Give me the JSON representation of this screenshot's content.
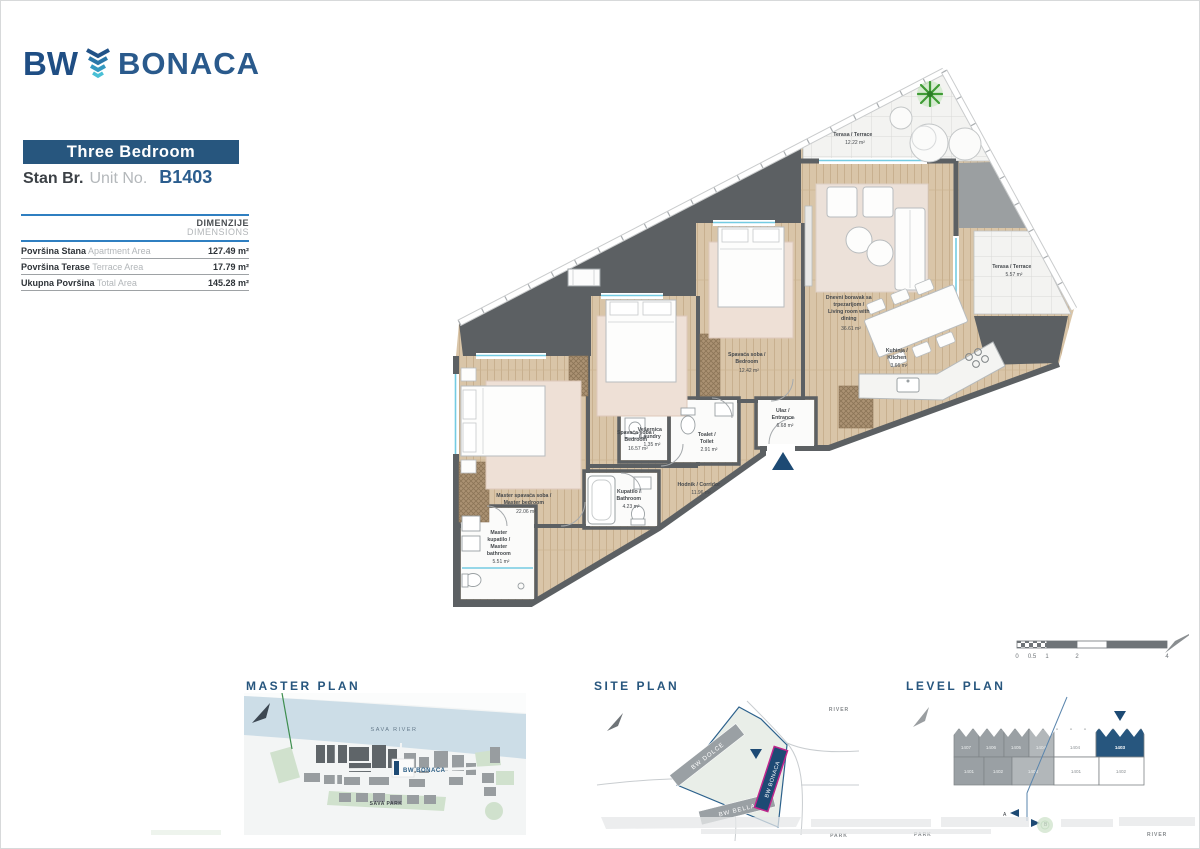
{
  "header": {
    "logo_bw": "BW",
    "logo_name": "BONACA",
    "unit_type": "Three Bedroom",
    "unit_label_sr": "Stan Br.",
    "unit_label_en": "Unit No.",
    "unit_number": "B1403"
  },
  "dimensions_table": {
    "header_sr": "DIMENZIJE",
    "header_en": "DIMENSIONS",
    "rows": [
      {
        "sr": "Površina Stana",
        "en": "Apartment Area",
        "value": "127.49 m²"
      },
      {
        "sr": "Površina Terase",
        "en": "Terrace Area",
        "value": "17.79 m²"
      },
      {
        "sr": "Ukupna Površina",
        "en": "Total Area",
        "value": "145.28 m²"
      }
    ]
  },
  "floorplan": {
    "living": {
      "l1": "Dnevni boravak sa",
      "l2": "trpezarijom /",
      "l3": "Living room with",
      "l4": "dining",
      "area": "36.61 m²"
    },
    "kitchen": {
      "sr": "Kuhinja /",
      "en": "Kitchen",
      "area": "3.66 m²"
    },
    "bedroom1": {
      "sr": "Spavaća soba /",
      "en": "Bedroom",
      "area": "12.42 m²"
    },
    "bedroom2": {
      "sr": "Spavaća soba /",
      "en": "Bedroom",
      "area": "16.57 m²"
    },
    "master_bedroom": {
      "sr": "Master spavaća soba /",
      "en": "Master bedroom",
      "area": "22.06 m²"
    },
    "corridor": {
      "label": "Hodnik / Corridor",
      "area": "11.96 m²"
    },
    "bathroom": {
      "sr": "Kupatilo /",
      "en": "Bathroom",
      "area": "4.23 m²"
    },
    "master_bathroom": {
      "l1": "Master",
      "l2": "kupatilo /",
      "l3": "Master",
      "l4": "bathroom",
      "area": "5.51 m²"
    },
    "laundry": {
      "l1": "Vešernica",
      "l2": "/Laundry",
      "area": "1.35 m²"
    },
    "toilet": {
      "sr": "Toalet /",
      "en": "Toilet",
      "area": "2.91 m²"
    },
    "entrance": {
      "sr": "Ulaz /",
      "en": "Entrance",
      "area": "6.68 m²"
    },
    "terrace_main": {
      "label": "Terasa / Terrace",
      "area": "12.22 m²"
    },
    "terrace_small": {
      "label": "Terasa / Terrace",
      "area": "5.57 m²"
    }
  },
  "scale_bar": {
    "ticks": [
      "0",
      "0.5",
      "1",
      "2",
      "4"
    ]
  },
  "thumbnails": {
    "master_plan": {
      "title": "MASTER PLAN",
      "river_label": "SAVA RIVER",
      "project_label": "BW BONACA",
      "park_label": "SAVA PARK"
    },
    "site_plan": {
      "title": "SITE PLAN",
      "building_dolce": "BW DOLCE",
      "building_bonaca": "BW BONACA",
      "building_bella": "BW BELLA",
      "river_label": "RIVER",
      "park_label": "PARK"
    },
    "level_plan": {
      "title": "LEVEL PLAN",
      "gray_top": [
        "1407",
        "1406",
        "1405",
        "1404"
      ],
      "gray_bottom": [
        "1401",
        "1402",
        "1403"
      ],
      "white_top": [
        "1404",
        "1403"
      ],
      "white_bottom": [
        "1401",
        "1402"
      ],
      "highlighted_unit": "1403",
      "section_a": "A",
      "section_b": "B",
      "park_label": "PARK",
      "river_label": "RIVER"
    }
  },
  "colors": {
    "navy": "#27567e",
    "blue": "#2a5a8c",
    "magenta": "#c0268c",
    "wall": "#5c6063",
    "wood": "#d8c3a5",
    "window": "#74cbe2",
    "tree_green": "#3f9c35"
  }
}
